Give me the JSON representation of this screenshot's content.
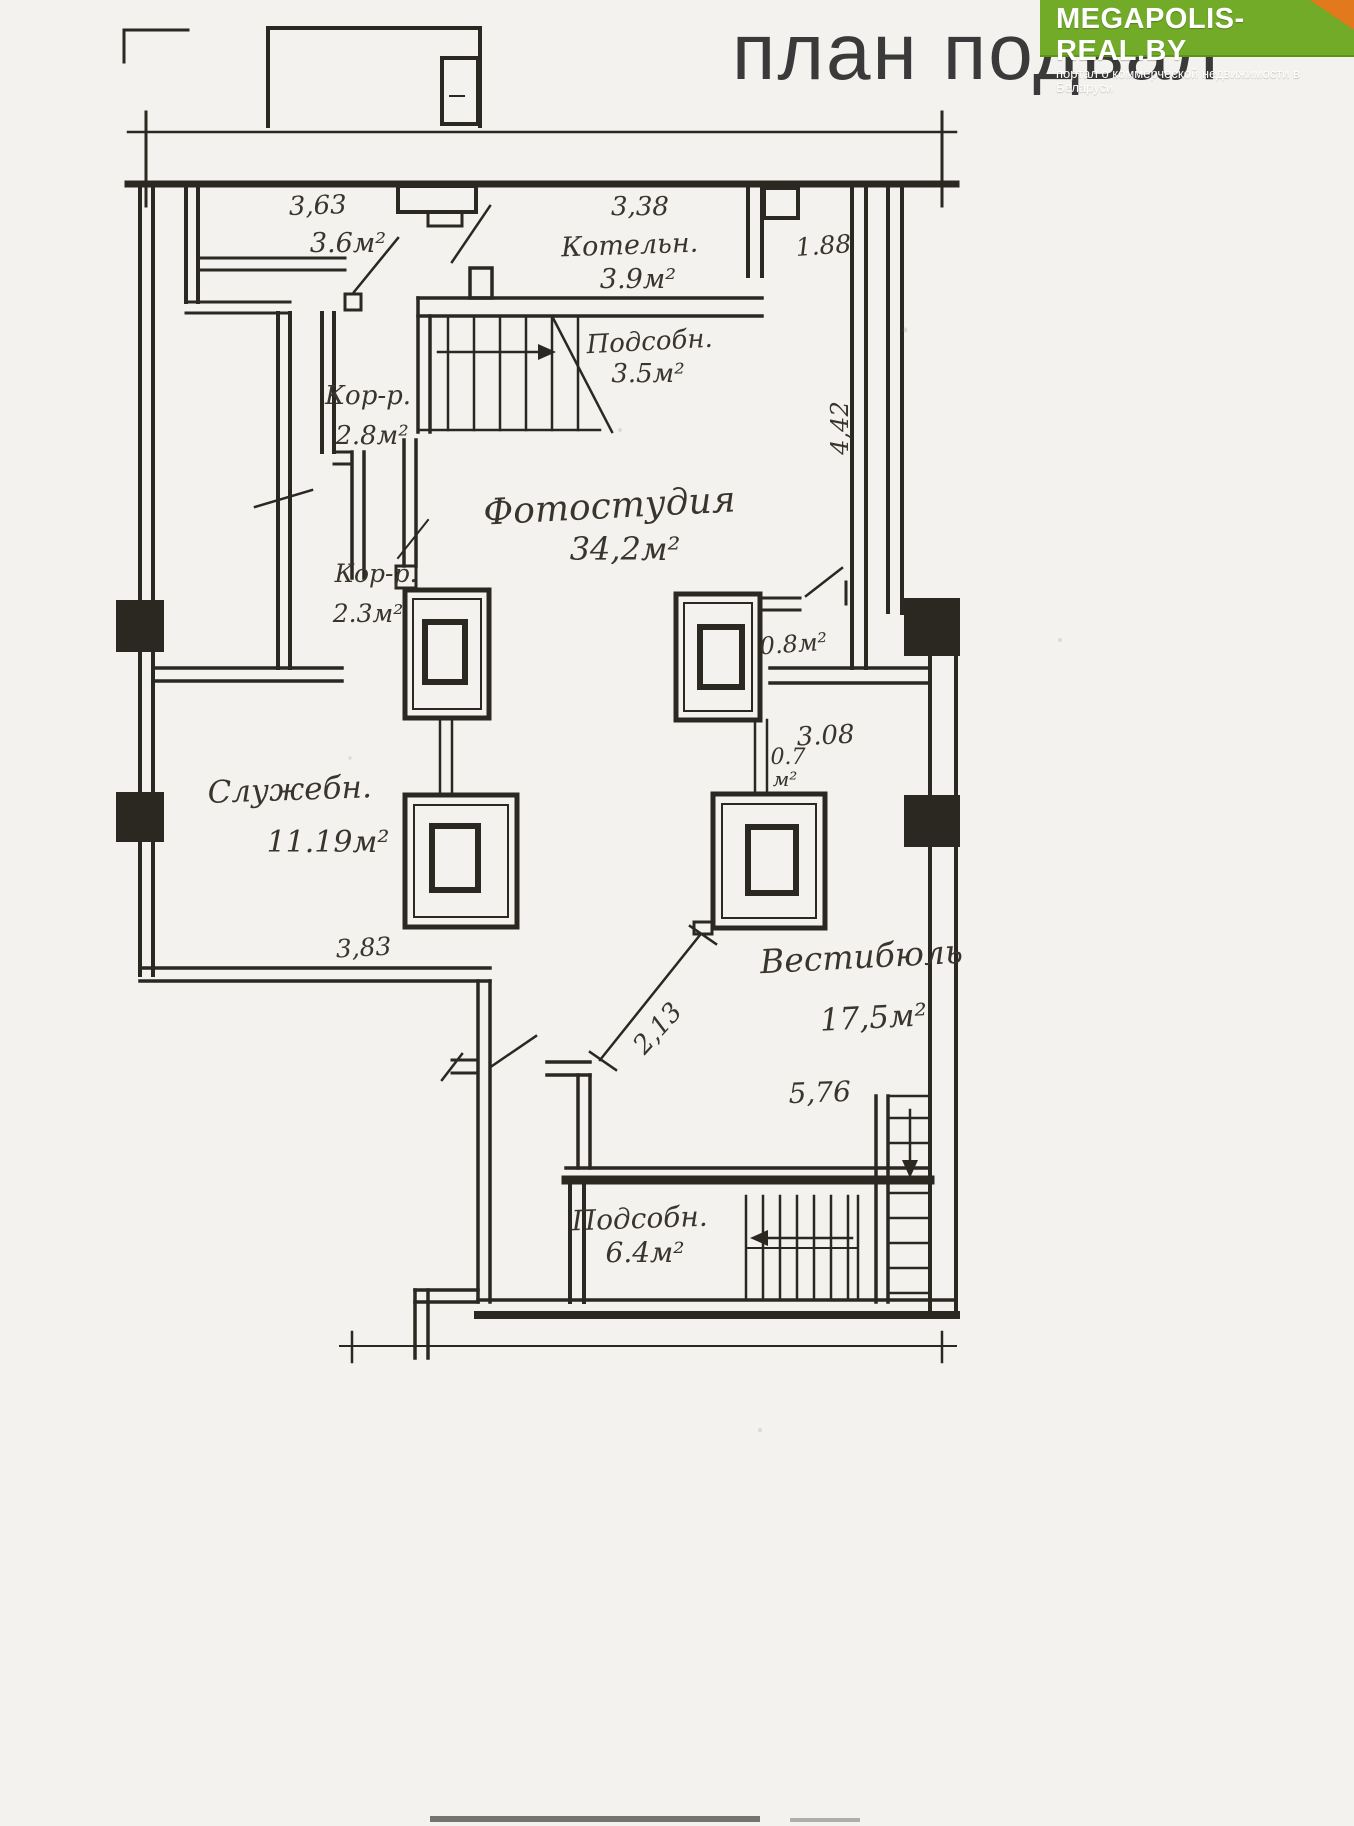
{
  "page": {
    "title": "план подвал"
  },
  "logo": {
    "name": "MEGAPOLIS-REAL.BY",
    "tagline": "портал о коммерческой недвижимости в Беларуси"
  },
  "colors": {
    "logo_green": "#72ab28",
    "logo_corner_orange": "#e2791c",
    "paper": "#f3f2ef",
    "ink": "#2b2822",
    "title_gray": "#3a3a3a"
  },
  "plan": {
    "type": "basement-floor-plan",
    "rooms": [
      {
        "name": "Котельн.",
        "area": "3.9м²"
      },
      {
        "name": "Подсобн.",
        "area": "3.5м²"
      },
      {
        "name": "Кор-р.",
        "area": "2.8м²"
      },
      {
        "name": "Кор-р.",
        "area": "2.3м²"
      },
      {
        "name": "Фотостудия",
        "area": "34,2м²"
      },
      {
        "name": "Служебн.",
        "area": "11.19м²"
      },
      {
        "name": "Вестибюль",
        "area": "17,5м²"
      },
      {
        "name": "Подсобн.",
        "area": "6.4м²"
      }
    ],
    "dims": {
      "d363": "3,63",
      "d36area": "3.6м²",
      "d338": "3,38",
      "d188": "1.88",
      "d442": "4,42",
      "d08area": "0.8м²",
      "d07_line1": "0.7",
      "d07_line2": "м²",
      "d308": "3.08",
      "d383": "3,83",
      "d213": "2,13",
      "d576": "5,76"
    }
  }
}
